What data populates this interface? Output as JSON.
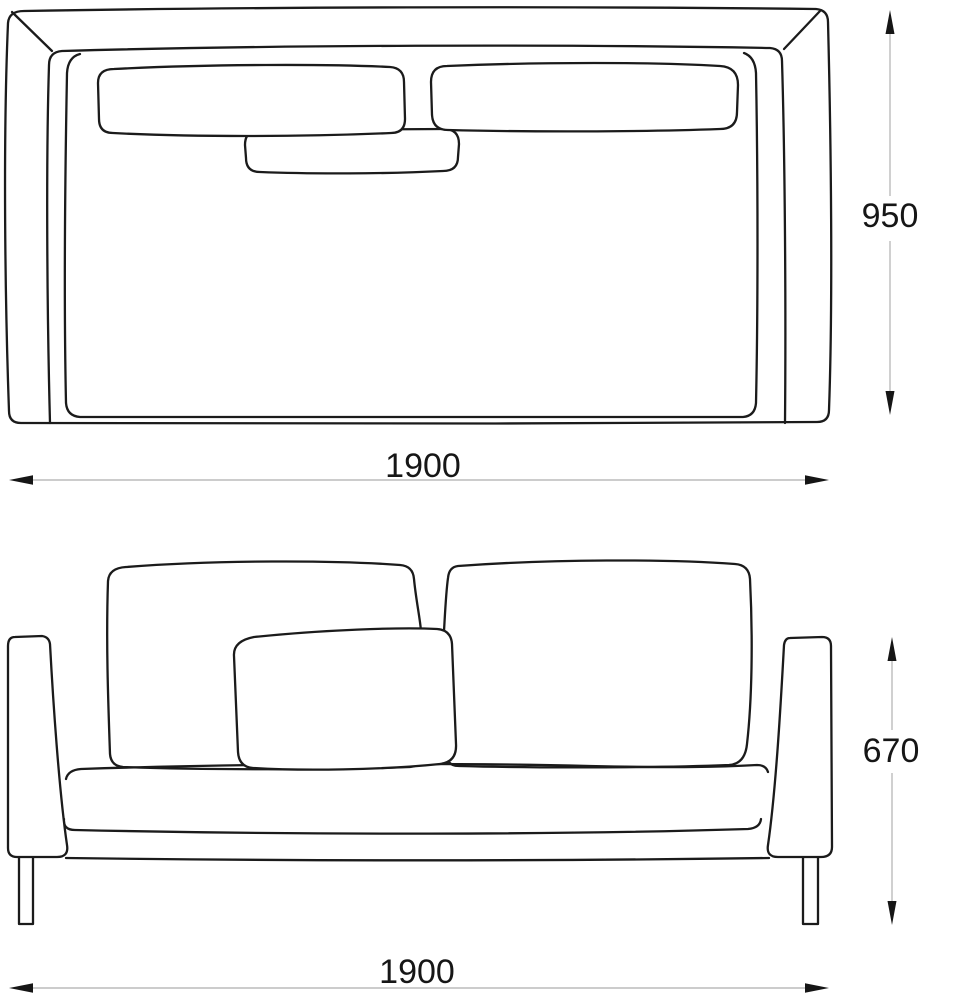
{
  "diagram": {
    "title": "Sofa technical drawing with dimensions",
    "views": {
      "top": {
        "name": "top-view-plan",
        "width": "1900",
        "depth": "950"
      },
      "front": {
        "name": "front-view-elevation",
        "width": "1900",
        "height": "670"
      }
    },
    "units": "mm",
    "colors": {
      "line": "#1b1b1b",
      "dim_line": "#bcbcbc",
      "text": "#161616",
      "background": "#ffffff"
    }
  }
}
